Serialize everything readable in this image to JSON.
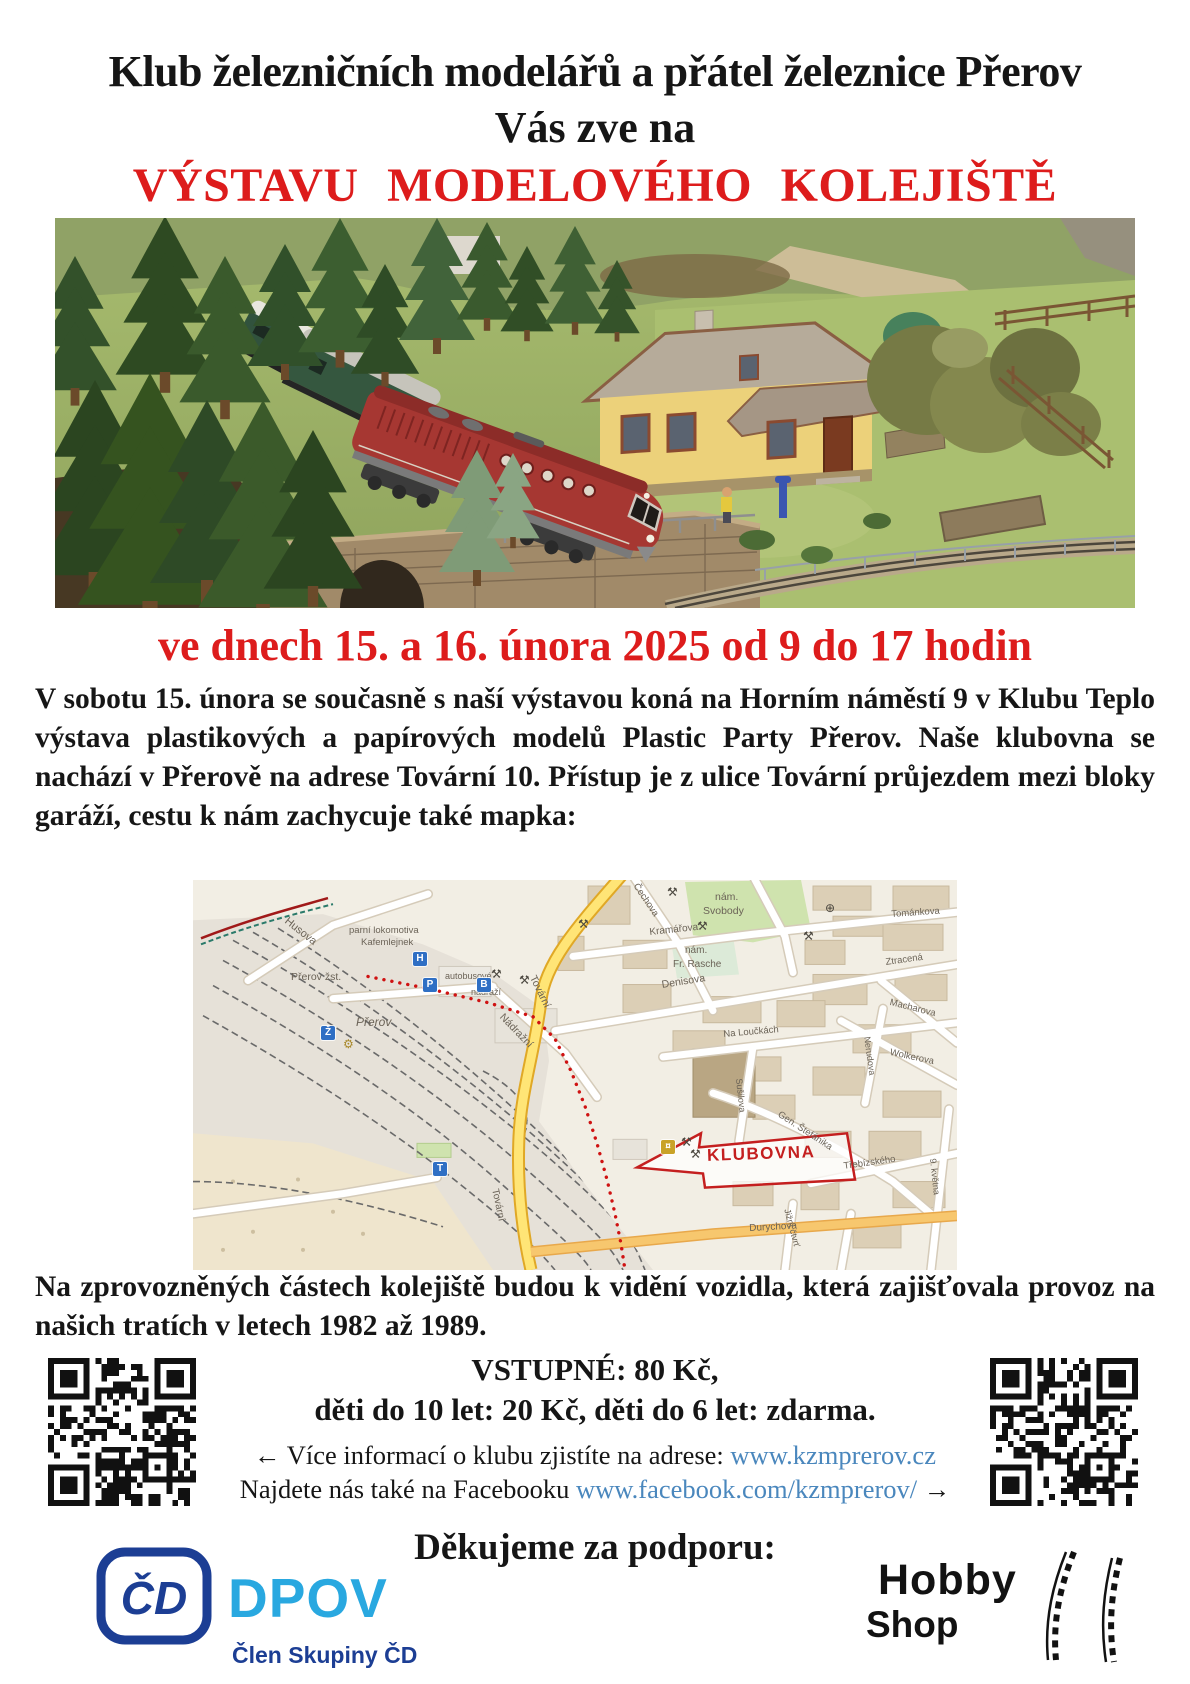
{
  "poster": {
    "header": {
      "line1": "Klub železničních modelářů a přátel železnice Přerov",
      "line2": "Vás zve na",
      "line3": "VÝSTAVU  MODELOVÉHO  KOLEJIŠTĚ"
    },
    "date_line": "ve dnech 15. a 16. února 2025 od 9 do 17 hodin",
    "intro_paragraph": "V sobotu 15. února se současně s naší výstavou koná na Horním náměstí 9 v Klubu Teplo výstava plastikových a papírových modelů Plastic Party Přerov. Naše klubovna se nachází v Přerově na adrese Tovární 10. Přístup je z ulice Tovární průjezdem mezi bloky garáží, cestu k nám zachycuje také mapka:",
    "vehicles_paragraph": "Na zprovozněných částech kolejiště budou k vidění vozidla, která zajišťovala provoz na našich tratích v letech 1982 až 1989.",
    "admission": {
      "line1": "VSTUPNÉ: 80 Kč,",
      "line2": "děti do 10 let: 20 Kč, děti do 6 let: zdarma."
    },
    "links": {
      "info_prefix": "← Více informací o klubu zjistíte na adrese: ",
      "website": "www.kzmprerov.cz",
      "facebook_prefix": "Najdete nás také na Facebooku ",
      "facebook_url": "www.facebook.com/kzmprerov/",
      "facebook_suffix": " →"
    },
    "thanks_heading": "Děkujeme za podporu:",
    "sponsors": {
      "cd_monogram": "ČD",
      "dpov_name": "DPOV",
      "cd_member_caption": "Člen Skupiny ČD",
      "hobby_word1": "Hobby",
      "hobby_word2": "Shop"
    }
  },
  "map": {
    "klubovna_label": "KLUBOVNA",
    "labels": [
      {
        "t": "Husova",
        "x": 96,
        "y": 36,
        "r": 38,
        "s": 11
      },
      {
        "t": "parní lokomotiva",
        "x": 156,
        "y": 46,
        "s": 9.5
      },
      {
        "t": "Kafemlejnek",
        "x": 168,
        "y": 58,
        "s": 9.5
      },
      {
        "t": "Přerov  žst.",
        "x": 98,
        "y": 92,
        "s": 10.5
      },
      {
        "t": "Přerov",
        "x": 163,
        "y": 136,
        "s": 12,
        "i": 1
      },
      {
        "t": "autobusové",
        "x": 252,
        "y": 92,
        "s": 9
      },
      {
        "t": "nádraží",
        "x": 278,
        "y": 108,
        "s": 9
      },
      {
        "t": "Tovární",
        "x": 344,
        "y": 94,
        "r": 64,
        "s": 10.5
      },
      {
        "t": "Nádražní",
        "x": 312,
        "y": 132,
        "r": 46,
        "s": 10.5
      },
      {
        "t": "nám.",
        "x": 522,
        "y": 12,
        "s": 10.5
      },
      {
        "t": "Svobody",
        "x": 510,
        "y": 26,
        "s": 10.5
      },
      {
        "t": "Čechova",
        "x": 446,
        "y": 2,
        "r": 56,
        "s": 9.5
      },
      {
        "t": "Kramářova",
        "x": 456,
        "y": 48,
        "r": -6,
        "s": 10
      },
      {
        "t": "nám.",
        "x": 492,
        "y": 66,
        "s": 10
      },
      {
        "t": "Fr. Rasche",
        "x": 480,
        "y": 80,
        "s": 10
      },
      {
        "t": "Denisova",
        "x": 468,
        "y": 100,
        "r": -9,
        "s": 10.5
      },
      {
        "t": "Tománkova",
        "x": 698,
        "y": 30,
        "r": -4,
        "s": 9.5
      },
      {
        "t": "Ztracená",
        "x": 692,
        "y": 78,
        "r": -8,
        "s": 9.5
      },
      {
        "t": "Macharova",
        "x": 698,
        "y": 118,
        "r": 14,
        "s": 9.5
      },
      {
        "t": "Na Loučkách",
        "x": 530,
        "y": 150,
        "r": -5,
        "s": 9.5
      },
      {
        "t": "Wolkerova",
        "x": 698,
        "y": 168,
        "r": 12,
        "s": 9.5
      },
      {
        "t": "Nerudova",
        "x": 678,
        "y": 156,
        "r": 82,
        "s": 9
      },
      {
        "t": "Sušilova",
        "x": 550,
        "y": 198,
        "r": 84,
        "s": 9
      },
      {
        "t": "Gen. Štefánika",
        "x": 588,
        "y": 230,
        "r": 33,
        "s": 9.5
      },
      {
        "t": "Třebízského",
        "x": 650,
        "y": 282,
        "r": -8,
        "s": 9.5
      },
      {
        "t": "Jižní čtvrť",
        "x": 598,
        "y": 328,
        "r": 75,
        "s": 9
      },
      {
        "t": "9. května",
        "x": 744,
        "y": 278,
        "r": 84,
        "s": 9
      },
      {
        "t": "Tovární",
        "x": 306,
        "y": 308,
        "r": 78,
        "s": 10
      },
      {
        "t": "Durychova",
        "x": 556,
        "y": 344,
        "r": -3,
        "s": 10
      }
    ],
    "icons": [
      {
        "k": "sq",
        "t": "P",
        "x": 230,
        "y": 98,
        "n": "parking-icon"
      },
      {
        "k": "bus",
        "t": "B",
        "x": 284,
        "y": 98,
        "n": "bus-icon"
      },
      {
        "k": "sq",
        "t": "T",
        "x": 240,
        "y": 282,
        "n": "tram-icon"
      },
      {
        "k": "sq",
        "t": "H",
        "x": 220,
        "y": 72,
        "n": "hotel-icon"
      },
      {
        "k": "sq",
        "t": "Ž",
        "x": 128,
        "y": 146,
        "n": "station-icon"
      },
      {
        "k": "gear",
        "x": 150,
        "y": 158,
        "n": "gear-icon"
      },
      {
        "k": "x",
        "x": 474,
        "y": 6,
        "n": "restaurant-icon"
      },
      {
        "k": "x",
        "x": 385,
        "y": 38,
        "n": "restaurant-icon"
      },
      {
        "k": "x",
        "x": 504,
        "y": 40,
        "n": "restaurant-icon"
      },
      {
        "k": "x",
        "x": 610,
        "y": 50,
        "n": "restaurant-icon"
      },
      {
        "k": "glb",
        "x": 632,
        "y": 22,
        "n": "globe-icon"
      },
      {
        "k": "x",
        "x": 298,
        "y": 88,
        "n": "restaurant-icon"
      },
      {
        "k": "x",
        "x": 326,
        "y": 94,
        "n": "restaurant-icon"
      },
      {
        "k": "x",
        "x": 488,
        "y": 256,
        "n": "restaurant-icon"
      },
      {
        "k": "x",
        "x": 497,
        "y": 268,
        "n": "restaurant-icon"
      },
      {
        "k": "atm",
        "t": "¤",
        "x": 468,
        "y": 260,
        "n": "atm-icon"
      }
    ]
  },
  "colors": {
    "accent_red": "#dd1c1c",
    "link_blue": "#4a87bd",
    "cd_navy": "#1c3e94",
    "dpov_blue": "#29a8e0"
  }
}
